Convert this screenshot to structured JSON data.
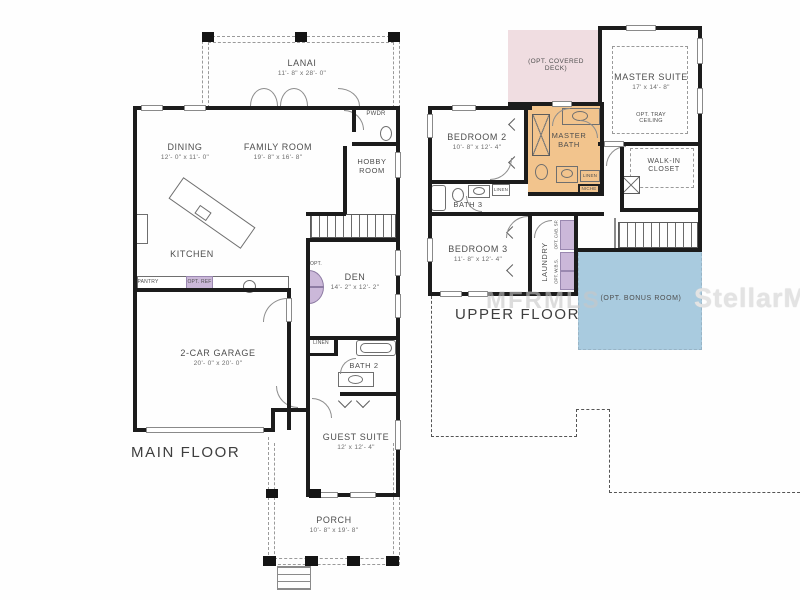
{
  "watermarks": {
    "center": "MFRMLS",
    "right": "StellarMLS"
  },
  "colors": {
    "wall": "#1c1c1c",
    "deck_pink": "#f0dde1",
    "bath_orange": "#f2c48d",
    "bonus_blue": "#a9cbdf",
    "opt_purple": "#cbb8d9"
  },
  "main_floor": {
    "title": "MAIN FLOOR",
    "lanai": {
      "name": "LANAI",
      "dims": "11'- 8\" x 28'- 0\""
    },
    "dining": {
      "name": "DINING",
      "dims": "12'- 0\" x 11'- 0\""
    },
    "family_room": {
      "name": "FAMILY ROOM",
      "dims": "19'- 8\" x 16'- 8\""
    },
    "powder": {
      "name": "PWDR"
    },
    "hobby_room": {
      "name": "HOBBY ROOM"
    },
    "kitchen": {
      "name": "KITCHEN"
    },
    "pantry": {
      "name": "PANTRY"
    },
    "opt_ref": {
      "name": "OPT. REF"
    },
    "den": {
      "name": "DEN",
      "dims": "14'- 2\" x 12'- 2\"",
      "opt": "OPT."
    },
    "garage": {
      "name": "2-CAR GARAGE",
      "dims": "20'- 0\" x 20'- 0\""
    },
    "linen": {
      "name": "LINEN"
    },
    "bath_2": {
      "name": "BATH 2"
    },
    "guest_suite": {
      "name": "GUEST SUITE",
      "dims": "12' x 12'- 4\""
    },
    "porch": {
      "name": "PORCH",
      "dims": "10'- 8\" x 19'- 8\""
    }
  },
  "upper_floor": {
    "title": "UPPER FLOOR",
    "opt_covered_deck": {
      "name": "(OPT. COVERED DECK)"
    },
    "master_suite": {
      "name": "MASTER SUITE",
      "dims": "17' x 14'- 8\"",
      "note": "OPT. TRAY CEILING"
    },
    "master_bath": {
      "name": "MASTER BATH"
    },
    "walk_in_closet": {
      "name": "WALK-IN CLOSET"
    },
    "bedroom_2": {
      "name": "BEDROOM 2",
      "dims": "10'- 8\" x 12'- 4\""
    },
    "bath_3": {
      "name": "BATH 3"
    },
    "bedroom_3": {
      "name": "BEDROOM 3",
      "dims": "11'- 8\" x 12'- 4\""
    },
    "laundry": {
      "name": "LAUNDRY"
    },
    "opt_cab": {
      "name": "OPT. CAB. SP."
    },
    "opt_wbs": {
      "name": "OPT. W.B.S."
    },
    "linen_bath3": {
      "name": "LINEN"
    },
    "linen_mbath": {
      "name": "LINEN"
    },
    "niche": {
      "name": "NICHE"
    },
    "opt_bonus_room": {
      "name": "(OPT. BONUS ROOM)"
    }
  }
}
